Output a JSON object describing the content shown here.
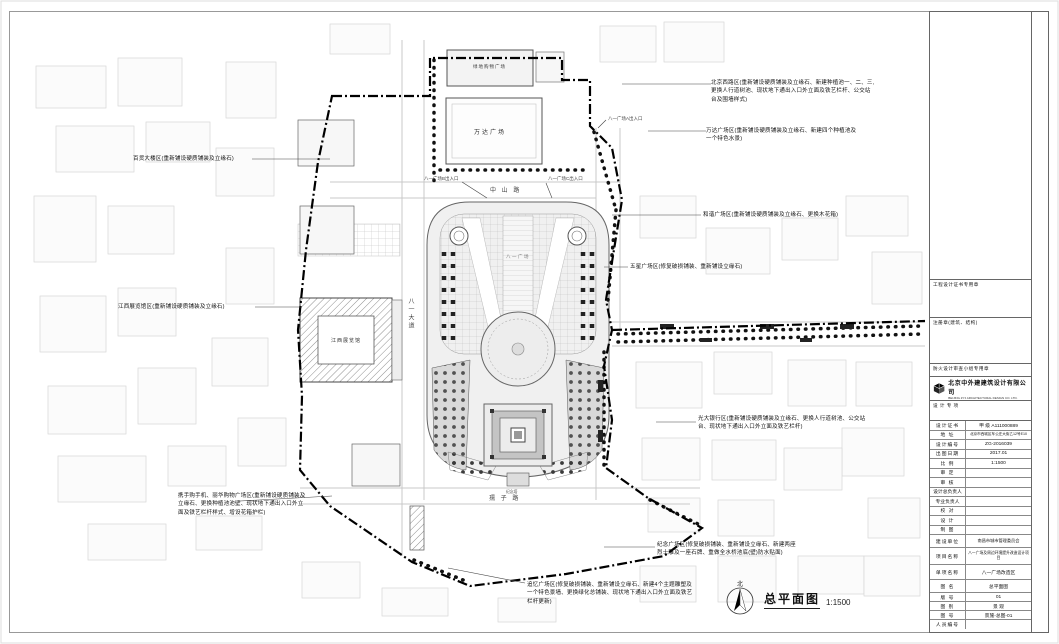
{
  "sheet": {
    "plan_title": "总平面图",
    "scale": "1:1500",
    "north": "北"
  },
  "annotations": {
    "a1": "北京西路区(重新铺设硬质铺装及立缘石、新建种植池一、二、三,更换人行道树池、现状地下通出入口外立面及铁艺栏杆、公交站台及围墙样式)",
    "a2": "万达广场区(重新铺设硬质铺装及立缘石、新建四个种植池及一个特色水景)",
    "a3": "和谐广场区(重新铺设硬质铺装及立缘石、更换木花箱)",
    "a4": "五星广场区(修复破损铺装、重新铺设立缘石)",
    "a5": "光大银行区(重新铺设硬质铺装及立缘石、更换人行道树池、公交站台、现状地下通出入口外立面及铁艺栏杆)",
    "a6": "百货大楼区(重新铺设硬质铺装及立缘石)",
    "a7": "江西展览馆区(重新铺设硬质铺装及立缘石)",
    "a8": "携手购手机、丽华购物广场区(重新铺设硬质铺装及立缘石、更换种植池池壁、现状地下通出入口外立面及铁艺栏杆样式、增设花箱护栏)",
    "a9": "纪念广场区(修复破损铺装、重新铺设立缘石、新建两座烈士雕及一座石牌、重做全水桥池底(壁)防水贴面)",
    "a10": "追忆广场区(修复破损铺装、重新铺设立缘石、新建4个主题雕塑及一个特色景墙、更换绿化总铺装、现状地下通出入口外立面及铁艺栏杆更新)"
  },
  "plan": {
    "wanda": "万达广场",
    "greenland": "绿地购物广场",
    "exhibition": "江西展览馆",
    "plaza": "八一广场",
    "monument": "纪念塔",
    "exit_a": "八一广场A出入口",
    "exit_b": "八一广场B出入口",
    "exit_c": "八一广场C出入口",
    "road_zhongshan": "中 山 路",
    "road_bayi": "八一大道",
    "road_ruzi": "孺 子 路"
  },
  "titleblock": {
    "stamp1": "工程设计证书专用章",
    "stamp2": "注册章(建筑、结构)",
    "stamp3": "防火设计审查小组专用章",
    "company_cn": "北京中外建建筑设计有限公司",
    "company_en": "BEIJING ZYJ ARCHITECTURAL DESIGN CO. LTD.",
    "section_label": "设 计 专 项",
    "rows": [
      {
        "label": "设计证书",
        "value": "甲 级 A111000889"
      },
      {
        "label": "地 址",
        "value": "北京市西城区车公庄大街乙12号E10"
      },
      {
        "label": "设计编号",
        "value": "ZG-2016039"
      },
      {
        "label": "出图日期",
        "value": "2017.01"
      },
      {
        "label": "比 例",
        "value": "1:1500"
      },
      {
        "label": "审 定",
        "value": ""
      },
      {
        "label": "审 核",
        "value": ""
      },
      {
        "label": "设计总负责人",
        "value": ""
      },
      {
        "label": "专业负责人",
        "value": ""
      },
      {
        "label": "校 对",
        "value": ""
      },
      {
        "label": "设 计",
        "value": ""
      },
      {
        "label": "制 图",
        "value": ""
      }
    ],
    "project_rows": [
      {
        "label": "建设单位",
        "value": "南昌市城市管理委员会"
      },
      {
        "label": "项目名称",
        "value": "八一广场及周边环境提升改造设计项目"
      },
      {
        "label": "单项名称",
        "value": "八一广场改造区"
      },
      {
        "label": "图 名",
        "value": "总平面图"
      },
      {
        "label": "版 号",
        "value": "01"
      },
      {
        "label": "图 别",
        "value": "景 观"
      },
      {
        "label": "图 号",
        "value": "景施-总图-01"
      },
      {
        "label": "人员编号",
        "value": ""
      }
    ]
  }
}
